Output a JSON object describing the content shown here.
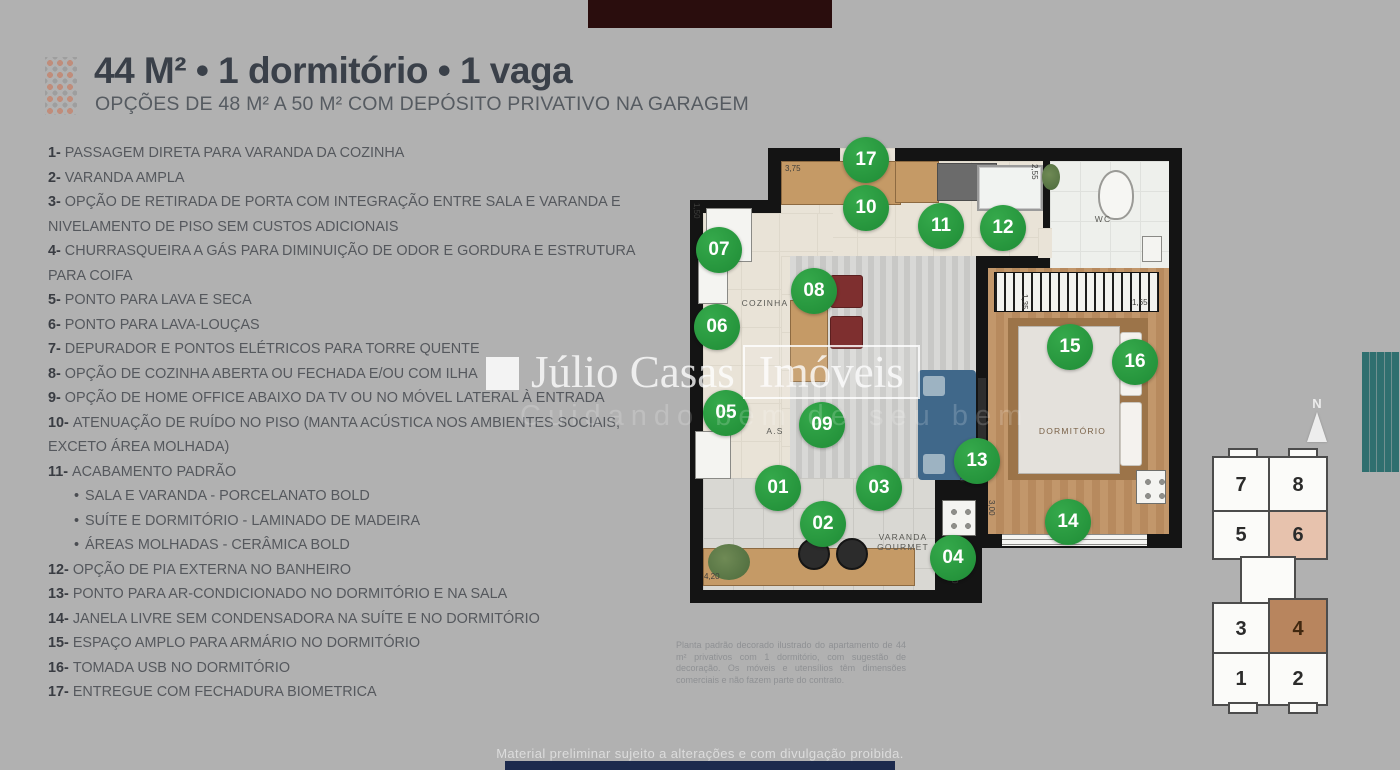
{
  "header": {
    "title": "44 M² • 1 dormitório • 1 vaga",
    "subtitle": "OPÇÕES DE 48 M² A 50 M² COM DEPÓSITO PRIVATIVO NA GARAGEM"
  },
  "bullet": "•",
  "features": [
    {
      "n": "1-",
      "t": "PASSAGEM DIRETA PARA VARANDA DA COZINHA"
    },
    {
      "n": "2-",
      "t": "VARANDA AMPLA"
    },
    {
      "n": "3-",
      "t": "OPÇÃO DE RETIRADA DE PORTA COM INTEGRAÇÃO ENTRE SALA E VARANDA E NIVELAMENTO DE PISO SEM CUSTOS ADICIONAIS"
    },
    {
      "n": "4-",
      "t": "CHURRASQUEIRA A GÁS PARA DIMINUIÇÃO DE ODOR E GORDURA E ESTRUTURA PARA COIFA"
    },
    {
      "n": "5-",
      "t": "PONTO PARA LAVA E SECA"
    },
    {
      "n": "6-",
      "t": "PONTO PARA LAVA-LOUÇAS"
    },
    {
      "n": "7-",
      "t": "DEPURADOR E PONTOS ELÉTRICOS PARA TORRE QUENTE"
    },
    {
      "n": "8-",
      "t": "OPÇÃO DE COZINHA ABERTA OU FECHADA E/OU COM ILHA"
    },
    {
      "n": "9-",
      "t": "OPÇÃO DE HOME OFFICE ABAIXO DA TV OU NO MÓVEL LATERAL À ENTRADA"
    },
    {
      "n": "10-",
      "t": "ATENUAÇÃO DE RUÍDO NO PISO (MANTA ACÚSTICA NOS AMBIENTES SOCIAIS, EXCETO ÁREA MOLHADA)"
    },
    {
      "n": "11-",
      "t": "ACABAMENTO PADRÃO",
      "subs": [
        "SALA E VARANDA - PORCELANATO BOLD",
        "SUÍTE E DORMITÓRIO - LAMINADO DE MADEIRA",
        "ÁREAS MOLHADAS - CERÂMICA BOLD"
      ]
    },
    {
      "n": "12-",
      "t": "OPÇÃO DE PIA EXTERNA NO BANHEIRO"
    },
    {
      "n": "13-",
      "t": "PONTO PARA AR-CONDICIONADO NO DORMITÓRIO E NA SALA"
    },
    {
      "n": "14-",
      "t": "JANELA LIVRE SEM CONDENSADORA NA SUÍTE E NO DORMITÓRIO"
    },
    {
      "n": "15-",
      "t": "ESPAÇO AMPLO PARA ARMÁRIO NO DORMITÓRIO"
    },
    {
      "n": "16-",
      "t": "TOMADA USB NO DORMITÓRIO"
    },
    {
      "n": "17-",
      "t": "ENTREGUE COM FECHADURA BIOMETRICA"
    }
  ],
  "floor_plan": {
    "markers": [
      "17",
      "10",
      "11",
      "12",
      "07",
      "08",
      "06",
      "15",
      "16",
      "05",
      "09",
      "13",
      "01",
      "03",
      "02",
      "04",
      "14"
    ],
    "marker_color": "#2f9e41",
    "rooms": {
      "cozinha": "COZINHA",
      "as": "A.S",
      "varanda1": "VARANDA",
      "varanda2": "GOURMET",
      "wc": "WC",
      "dormitorio": "DORMITÓRIO"
    },
    "dims": [
      "3,75",
      "1,50",
      "2,55",
      "1,35",
      "1,65",
      "2,40",
      "3,00",
      "4,20",
      "1,50"
    ]
  },
  "watermark": {
    "line1a": "Júlio Casas",
    "line1b": "Imóveis",
    "line2": "Cuidando bem de seu bem"
  },
  "plan_note": "Planta padrão decorado ilustrado do apartamento de 44 m² privativos com 1 dormitório, com sugestão de decoração. Os móveis e utensílios têm dimensões comerciais e não fazem parte do contrato.",
  "footer": "Material preliminar sujeito a alterações e com divulgação proibida.",
  "keyplan": {
    "north": "N",
    "units": [
      "7",
      "8",
      "5",
      "6",
      "3",
      "4",
      "1",
      "2"
    ],
    "highlight_unit6": "#e7c2ad",
    "highlight_unit4": "#b8855e"
  },
  "colors": {
    "background": "#b1b1b1",
    "marker_green": "#2f9e41",
    "top_bar": "#2a0d0d",
    "bottom_bar": "#1c2a4d",
    "teal_dots": "#2f6f6f"
  }
}
